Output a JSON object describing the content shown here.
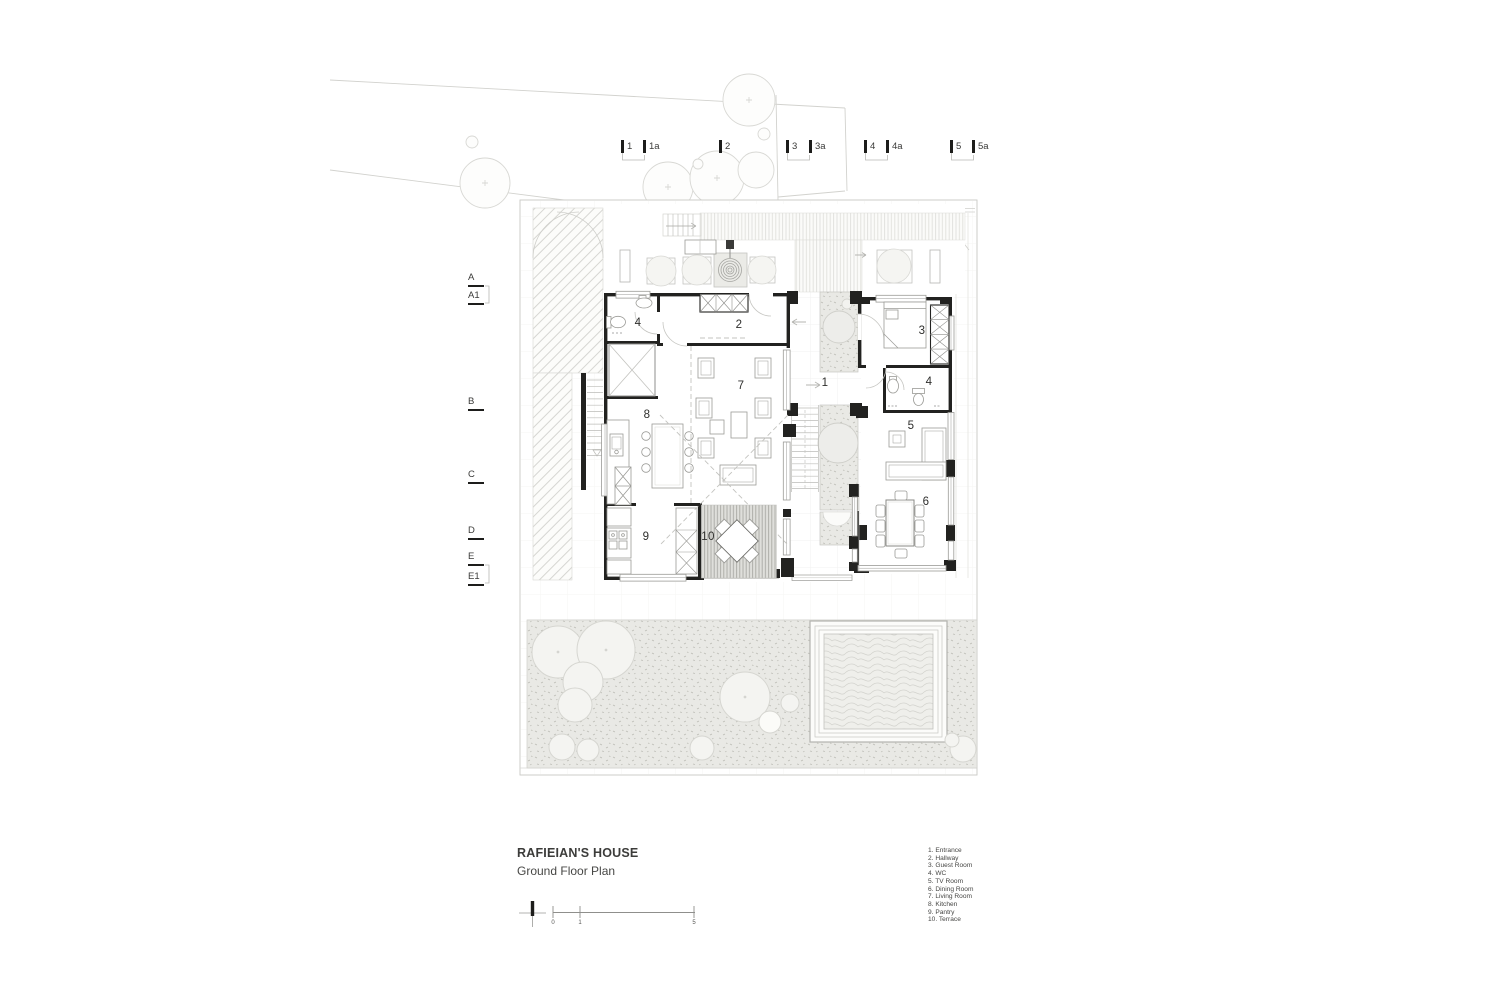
{
  "title_block": {
    "project": "RAFIEIAN'S HOUSE",
    "drawing": "Ground Floor Plan"
  },
  "legend": {
    "items": [
      "1. Entrance",
      "2. Hallway",
      "3. Guest Room",
      "4. WC",
      "5. TV Room",
      "6. Dining Room",
      "7. Living Room",
      "8. Kitchen",
      "9. Pantry",
      "10. Terrace"
    ]
  },
  "grid_axes": {
    "top": [
      "1",
      "1a",
      "2",
      "3",
      "3a",
      "4",
      "4a",
      "5",
      "5a"
    ],
    "left": [
      "A",
      "A1",
      "B",
      "C",
      "D",
      "E",
      "E1"
    ]
  },
  "plan_labels": [
    {
      "num": "1",
      "room": "Entrance"
    },
    {
      "num": "2",
      "room": "Hallway"
    },
    {
      "num": "3",
      "room": "Guest Room"
    },
    {
      "num": "4",
      "room": "WC"
    },
    {
      "num": "4",
      "room": "WC"
    },
    {
      "num": "5",
      "room": "TV Room"
    },
    {
      "num": "6",
      "room": "Dining Room"
    },
    {
      "num": "7",
      "room": "Living Room"
    },
    {
      "num": "8",
      "room": "Kitchen"
    },
    {
      "num": "9",
      "room": "Pantry"
    },
    {
      "num": "10",
      "room": "Terrace"
    }
  ],
  "scale_bar": {
    "ticks": [
      "0",
      "1",
      "5"
    ]
  },
  "colors": {
    "wall": "#222220",
    "furniture_line": "#9b9b97",
    "texture_fill": "#e9e9e5",
    "canopy_fill": "#f3f3f0"
  }
}
